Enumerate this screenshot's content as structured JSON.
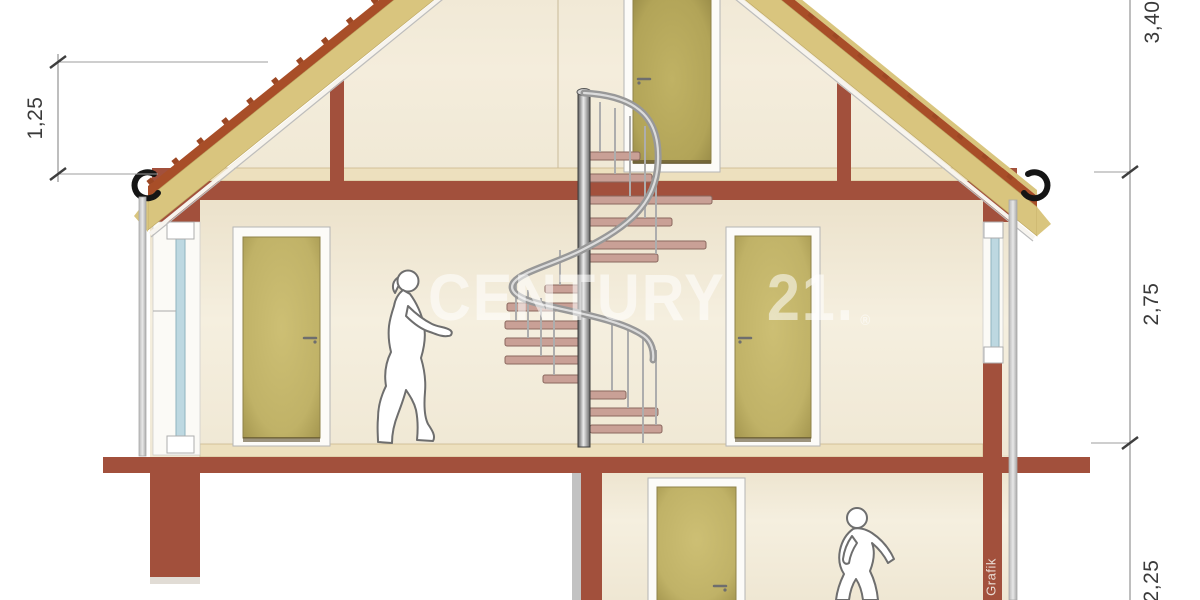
{
  "title": "house-cross-section-drawing",
  "watermark": {
    "word1": "CENTURY",
    "word2": "21.",
    "registered": "®"
  },
  "credit_text": "Grafik",
  "dimensions": {
    "knee_wall": "1,25",
    "ridge": "3,40",
    "upper_floor": "2,75",
    "ground_floor": "2,25"
  },
  "scene": {
    "staircase": "spiral",
    "doors_visible": 4,
    "figures": 2,
    "windows": 2,
    "gutter_hooks": 2
  },
  "colors": {
    "wall_terracotta": "#A2503C",
    "roof_tile": "#A84E28",
    "roof_insulation": "#D9C57E",
    "interior_cream": "#F3ECDA",
    "floor_finish": "#EDE0BE",
    "door_panel": "#C2B368",
    "window_glass": "#BDD8E1",
    "stair_tread": "#C9A096",
    "stair_metal": "#9A9A9A",
    "figure_outline": "#6E6E6E",
    "dimension_text": "#3A3A3A",
    "watermark_white": "#FFFFFF"
  }
}
